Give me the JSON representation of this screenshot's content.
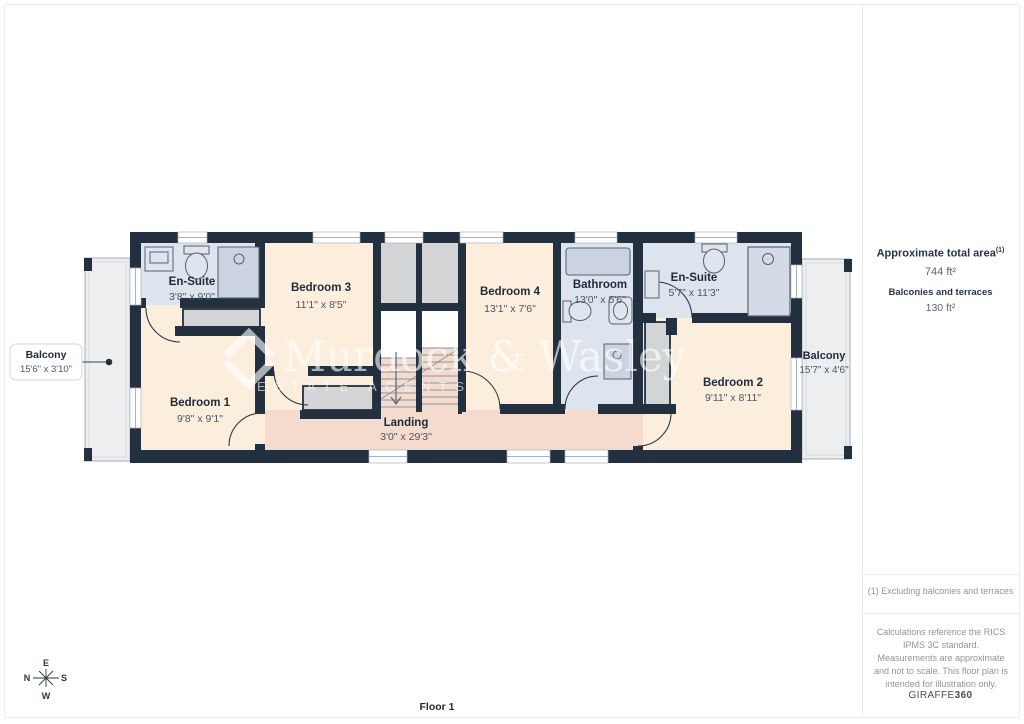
{
  "page": {
    "floor_label": "Floor 1"
  },
  "plan": {
    "rooms": [
      {
        "id": "ensuite-left",
        "name": "En-Suite",
        "dims": "3'8\" x 9'0\""
      },
      {
        "id": "bedroom-3",
        "name": "Bedroom 3",
        "dims": "11'1\" x 8'5\""
      },
      {
        "id": "bedroom-4",
        "name": "Bedroom 4",
        "dims": "13'1\" x 7'6\""
      },
      {
        "id": "bathroom",
        "name": "Bathroom",
        "dims": "13'0\" x 5'6\""
      },
      {
        "id": "ensuite-right",
        "name": "En-Suite",
        "dims": "5'7\" x 11'3\""
      },
      {
        "id": "bedroom-1",
        "name": "Bedroom 1",
        "dims": "9'8\" x 9'1\""
      },
      {
        "id": "bedroom-2",
        "name": "Bedroom 2",
        "dims": "9'11\" x 8'11\""
      },
      {
        "id": "landing",
        "name": "Landing",
        "dims": "3'0\" x 29'3\""
      }
    ],
    "balcony_left": {
      "name": "Balcony",
      "dims": "15'6\" x 3'10\""
    },
    "balcony_right": {
      "name": "Balcony",
      "dims": "15'7\" x 4'6\""
    }
  },
  "compass": {
    "up": "E",
    "left": "N",
    "right": "S",
    "down": "W"
  },
  "watermark": {
    "name": "Murdock & Wasley",
    "tagline": "ESTATE AGENTS"
  },
  "sidebar": {
    "total_area_label": "Approximate total area",
    "total_area_marker": "(1)",
    "total_area_value": "744 ft²",
    "balconies_label": "Balconies and terraces",
    "balconies_value": "130 ft²",
    "footnote": "(1) Excluding balconies and terraces",
    "disclaimer": "Calculations reference the RICS IPMS 3C standard. Measurements are approximate and not to scale. This floor plan is intended for illustration only.",
    "brand": "GIRAFFE",
    "brand_bold": "360"
  },
  "colors": {
    "wall": "#22303f",
    "bedroom_fill": "#fceedd",
    "landing_fill": "#f4dbce",
    "wet_room_fill": "#dee4ee",
    "wardrobe_fill": "#d2d4d6",
    "balcony_fill": "#eceeef",
    "label_text": "#1f2b3a",
    "dim_text": "#4a566a"
  }
}
